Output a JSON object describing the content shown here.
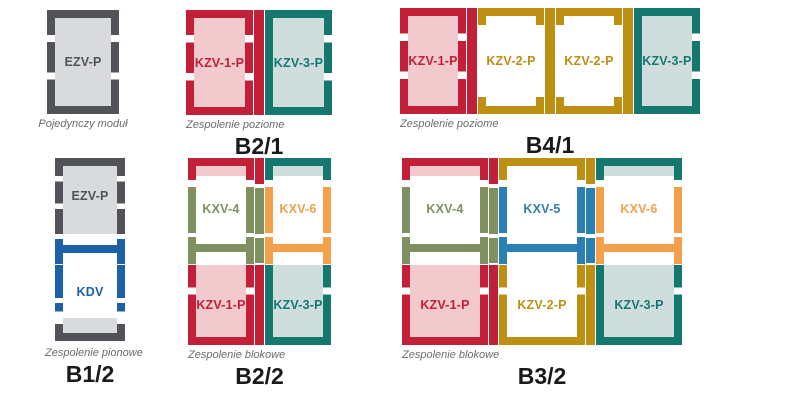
{
  "palette": {
    "red": "#c22038",
    "pink_tint": "#f2c9cc",
    "teal": "#15786f",
    "teal_tint": "#cfdedd",
    "gold": "#bd9013",
    "gray": "#515358",
    "gray_tint": "#d9dadb",
    "blue": "#1c60a8",
    "green": "#7f9160",
    "orange": "#f3a04b",
    "sky_blue": "#2b80b2",
    "caption_gray": "#6b6b6b",
    "label_black": "#1a1a1a",
    "background": "#ffffff"
  },
  "groups": {
    "single": {
      "caption": "Pojedynczy moduł",
      "module": {
        "label": "EZV-P"
      }
    },
    "b21": {
      "name": "B2/1",
      "caption": "Zespolenie poziome",
      "modules": [
        {
          "label": "KZV-1-P"
        },
        {
          "label": "KZV-3-P"
        }
      ]
    },
    "b41": {
      "name": "B4/1",
      "caption": "Zespolenie poziome",
      "modules": [
        {
          "label": "KZV-1-P"
        },
        {
          "label": "KZV-2-P"
        },
        {
          "label": "KZV-2-P"
        },
        {
          "label": "KZV-3-P"
        }
      ]
    },
    "b12": {
      "name": "B1/2",
      "caption": "Zespolenie pionowe",
      "top_module": {
        "label": "EZV-P"
      },
      "bottom_module": {
        "label": "KDV"
      }
    },
    "b22": {
      "name": "B2/2",
      "caption": "Zespolenie blokowe",
      "top_modules": [
        {
          "label": "KXV-4"
        },
        {
          "label": "KXV-6"
        }
      ],
      "bottom_modules": [
        {
          "label": "KZV-1-P"
        },
        {
          "label": "KZV-3-P"
        }
      ]
    },
    "b32": {
      "name": "B3/2",
      "caption": "Zespolenie blokowe",
      "top_modules": [
        {
          "label": "KXV-4"
        },
        {
          "label": "KXV-5"
        },
        {
          "label": "KXV-6"
        }
      ],
      "bottom_modules": [
        {
          "label": "KZV-1-P"
        },
        {
          "label": "KZV-2-P"
        },
        {
          "label": "KZV-3-P"
        }
      ]
    }
  }
}
